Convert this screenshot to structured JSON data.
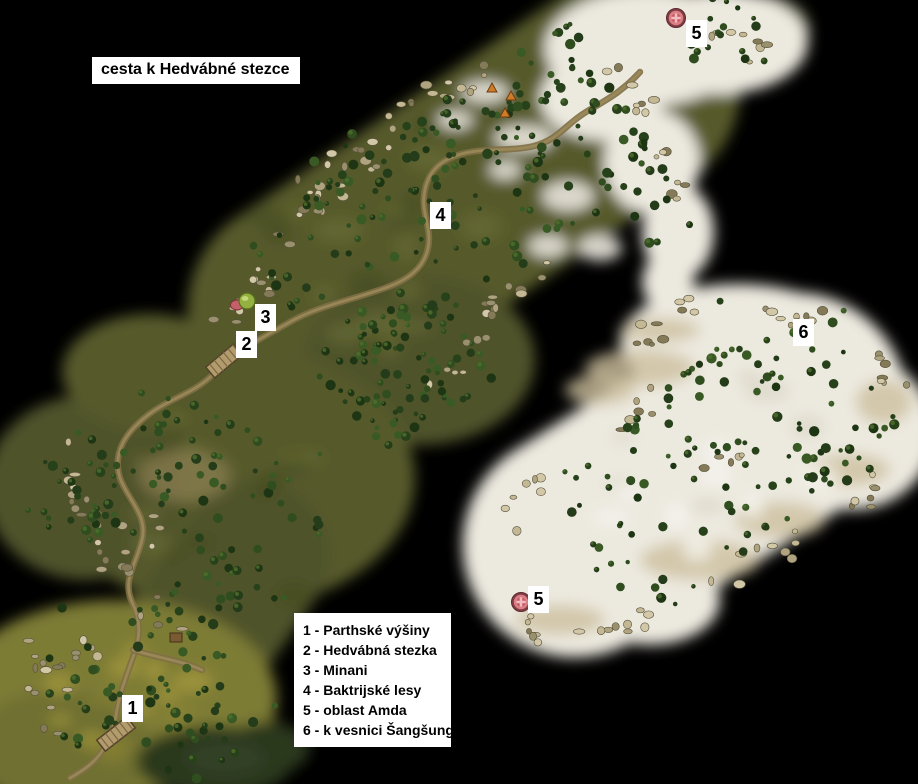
{
  "title": "cesta k Hedvábné stezce",
  "legend": {
    "items": [
      "1 - Parthské výšiny",
      "2 - Hedvábná stezka",
      "3 - Minani",
      "4 - Baktrijské lesy",
      "5 - oblast Amda",
      "6 - k vesnici Šangšung"
    ]
  },
  "map": {
    "markers": [
      {
        "label": "1",
        "x": 122,
        "y": 695
      },
      {
        "label": "2",
        "x": 236,
        "y": 331
      },
      {
        "label": "3",
        "x": 255,
        "y": 304
      },
      {
        "label": "4",
        "x": 430,
        "y": 202
      },
      {
        "label": "5",
        "x": 686,
        "y": 20
      },
      {
        "label": "5",
        "x": 528,
        "y": 586
      },
      {
        "label": "6",
        "x": 793,
        "y": 319
      }
    ],
    "portals": [
      {
        "x": 676,
        "y": 18
      },
      {
        "x": 521,
        "y": 602
      }
    ],
    "village": {
      "x": 244,
      "y": 301
    }
  },
  "colors": {
    "background": "#000000",
    "label_bg": "#ffffff",
    "label_text": "#000000",
    "terrain_green": "#565a2b",
    "terrain_autumn": "#7d7c35",
    "terrain_snow": "#ece9df",
    "water": "#2b381f",
    "road": "#7f6f46",
    "rock": "#c3b794",
    "tree": "#27421a",
    "portal_red": "#c9565e"
  }
}
